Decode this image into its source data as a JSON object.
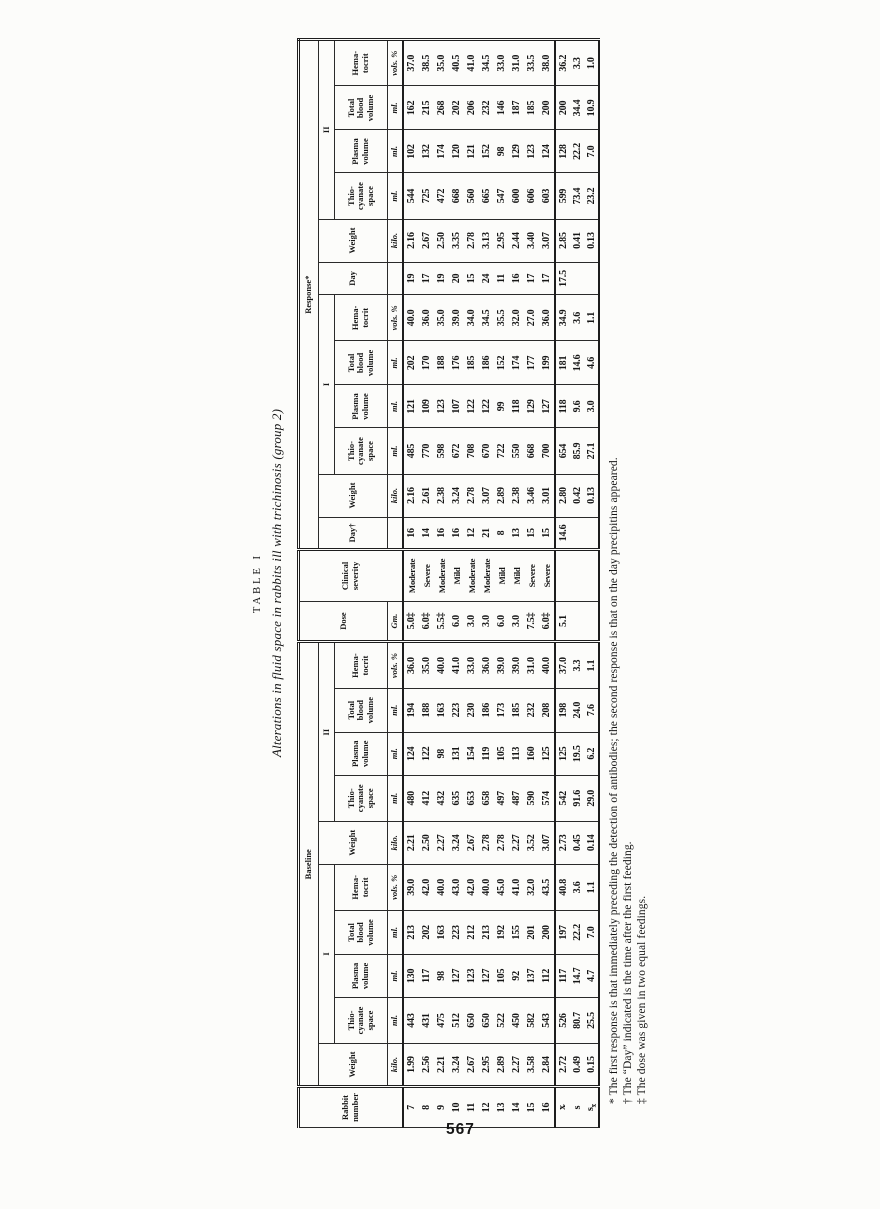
{
  "page": {
    "number": "567"
  },
  "title": {
    "label": "TABLE I",
    "caption": "Alterations in fluid space in rabbits ill with trichinosis (group 2)"
  },
  "table": {
    "head": {
      "stub": "Rabbit\nnumber",
      "baseline": "Baseline",
      "dose": "Dose",
      "severity": "Clinical\nseverity",
      "response": "Response*",
      "g1": "I",
      "g2": "II",
      "weight": "Weight",
      "day1": "Day†",
      "day2": "Day",
      "thio": "Thio-\ncyanate\nspace",
      "plasma": "Plasma\nvolume",
      "tbv": "Total\nblood\nvolume",
      "hct": "Hema-\ntocrit",
      "u_weight": "kilo.",
      "u_ml": "ml.",
      "u_hct": "vols. %",
      "u_dose": "Gm.",
      "u_blank": ""
    },
    "rows": [
      [
        "7",
        "1.99",
        "443",
        "130",
        "213",
        "39.0",
        "2.21",
        "480",
        "124",
        "194",
        "36.0",
        "5.0‡",
        "Moderate",
        "16",
        "2.16",
        "485",
        "121",
        "202",
        "40.0",
        "19",
        "2.16",
        "544",
        "102",
        "162",
        "37.0"
      ],
      [
        "8",
        "2.56",
        "431",
        "117",
        "202",
        "42.0",
        "2.50",
        "412",
        "122",
        "188",
        "35.0",
        "6.0‡",
        "Severe",
        "14",
        "2.61",
        "770",
        "109",
        "170",
        "36.0",
        "17",
        "2.67",
        "725",
        "132",
        "215",
        "38.5"
      ],
      [
        "9",
        "2.21",
        "475",
        "98",
        "163",
        "40.0",
        "2.27",
        "432",
        "98",
        "163",
        "40.0",
        "5.5‡",
        "Moderate",
        "16",
        "2.38",
        "598",
        "123",
        "188",
        "35.0",
        "19",
        "2.50",
        "472",
        "174",
        "268",
        "35.0"
      ],
      [
        "10",
        "3.24",
        "512",
        "127",
        "223",
        "43.0",
        "3.24",
        "635",
        "131",
        "223",
        "41.0",
        "6.0",
        "Mild",
        "16",
        "3.24",
        "672",
        "107",
        "176",
        "39.0",
        "20",
        "3.35",
        "668",
        "120",
        "202",
        "40.5"
      ],
      [
        "11",
        "2.67",
        "650",
        "123",
        "212",
        "42.0",
        "2.67",
        "653",
        "154",
        "230",
        "33.0",
        "3.0",
        "Moderate",
        "12",
        "2.78",
        "708",
        "122",
        "185",
        "34.0",
        "15",
        "2.78",
        "560",
        "121",
        "206",
        "41.0"
      ],
      [
        "12",
        "2.95",
        "650",
        "127",
        "213",
        "40.0",
        "2.78",
        "658",
        "119",
        "186",
        "36.0",
        "3.0",
        "Moderate",
        "21",
        "3.07",
        "670",
        "122",
        "186",
        "34.5",
        "24",
        "3.13",
        "665",
        "152",
        "232",
        "34.5"
      ],
      [
        "13",
        "2.89",
        "522",
        "105",
        "192",
        "45.0",
        "2.78",
        "497",
        "105",
        "173",
        "39.0",
        "6.0",
        "Mild",
        "8",
        "2.89",
        "722",
        "99",
        "152",
        "35.5",
        "11",
        "2.95",
        "547",
        "98",
        "146",
        "33.0"
      ],
      [
        "14",
        "2.27",
        "450",
        "92",
        "155",
        "41.0",
        "2.27",
        "487",
        "113",
        "185",
        "39.0",
        "3.0",
        "Mild",
        "13",
        "2.38",
        "550",
        "118",
        "174",
        "32.0",
        "16",
        "2.44",
        "600",
        "129",
        "187",
        "31.0"
      ],
      [
        "15",
        "3.58",
        "582",
        "137",
        "201",
        "32.0",
        "3.52",
        "590",
        "160",
        "232",
        "31.0",
        "7.5‡",
        "Severe",
        "15",
        "3.46",
        "668",
        "129",
        "177",
        "27.0",
        "17",
        "3.40",
        "606",
        "123",
        "185",
        "33.5"
      ],
      [
        "16",
        "2.84",
        "543",
        "112",
        "200",
        "43.5",
        "3.07",
        "574",
        "125",
        "208",
        "40.0",
        "6.0‡",
        "Severe",
        "15",
        "3.01",
        "700",
        "127",
        "199",
        "36.0",
        "17",
        "3.07",
        "603",
        "124",
        "200",
        "38.0"
      ]
    ],
    "stats": [
      [
        "x̄",
        "2.72",
        "526",
        "117",
        "197",
        "40.8",
        "2.73",
        "542",
        "125",
        "198",
        "37.0",
        "5.1",
        "",
        "14.6",
        "2.80",
        "654",
        "118",
        "181",
        "34.9",
        "17.5",
        "2.85",
        "599",
        "128",
        "200",
        "36.2"
      ],
      [
        "s",
        "0.49",
        "80.7",
        "14.7",
        "22.2",
        "3.6",
        "0.45",
        "91.6",
        "19.5",
        "24.0",
        "3.3",
        "",
        "",
        "",
        "0.42",
        "85.9",
        "9.6",
        "14.6",
        "3.6",
        "",
        "0.41",
        "73.4",
        "22.2",
        "34.4",
        "3.3"
      ],
      [
        "sx̄",
        "0.15",
        "25.5",
        "4.7",
        "7.0",
        "1.1",
        "0.14",
        "29.0",
        "6.2",
        "7.6",
        "1.1",
        "",
        "",
        "",
        "0.13",
        "27.1",
        "3.0",
        "4.6",
        "1.1",
        "",
        "0.13",
        "23.2",
        "7.0",
        "10.9",
        "1.0"
      ]
    ]
  },
  "footnotes": [
    "* The first response is that immediately preceding the detection of antibodies; the second response is that on the day precipitins appeared.",
    "† The “Day” indicated is the time after the first feeding.",
    "‡ The dose was given in two equal feedings."
  ]
}
